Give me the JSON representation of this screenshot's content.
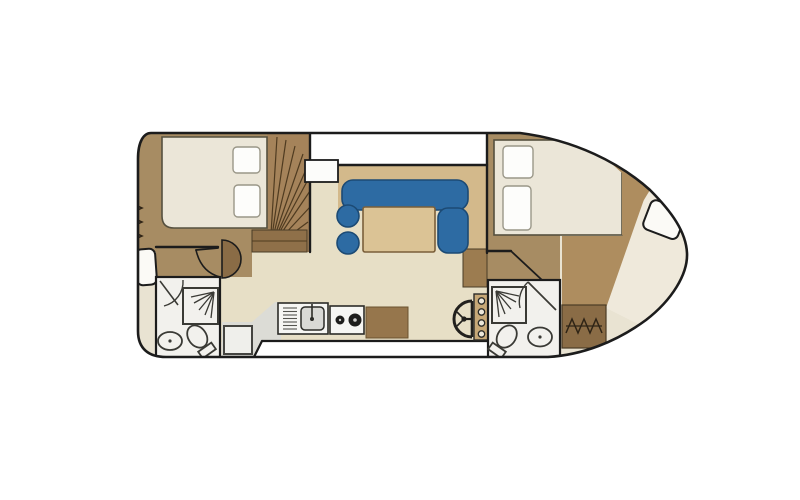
{
  "diagram": {
    "type": "boat-floor-plan",
    "description": "Top-down interior layout plan of a motor cruiser with bow to the right",
    "areas": {
      "stern_deck": {
        "label": "stern deck with boarding steps"
      },
      "aft_cabin": {
        "label": "aft cabin with double bed"
      },
      "staircase": {
        "label": "curved companionway stairs"
      },
      "salon": {
        "label": "salon with L-shaped sofa and table"
      },
      "galley": {
        "label": "galley with sink and stove"
      },
      "helm": {
        "label": "helm station with steering wheel and gauges"
      },
      "aft_bathroom": {
        "label": "aft bathroom with shower, toilet and washbasin"
      },
      "fwd_bathroom": {
        "label": "forward bathroom with shower, toilet and washbasin"
      },
      "fwd_cabin": {
        "label": "forward cabin with double bed"
      },
      "bow_deck": {
        "label": "bow deck with locker seat and steps"
      },
      "walkway": {
        "label": "side walkway deck"
      }
    },
    "fixtures": {
      "bed_aft": {
        "label": "double bed with two pillows"
      },
      "bed_fwd": {
        "label": "double bed with two pillows"
      },
      "sofa": {
        "label": "L-shaped blue sofa"
      },
      "table": {
        "label": "salon table"
      },
      "stools": {
        "label": "two round blue stools"
      },
      "sink_unit": {
        "label": "galley sink with drainer and faucet"
      },
      "stove": {
        "label": "two-burner stove"
      },
      "counter": {
        "label": "galley counter cabinet"
      },
      "fridge": {
        "label": "under-counter unit"
      },
      "wheel": {
        "label": "steering wheel"
      },
      "gauges": {
        "label": "instrument panel with four gauges"
      },
      "shower": {
        "label": "shower tray"
      },
      "toilet": {
        "label": "toilet"
      },
      "basin": {
        "label": "washbasin"
      },
      "bow_seat": {
        "label": "bow locker seat"
      },
      "steps": {
        "label": "deck access steps"
      }
    }
  },
  "colors": {
    "wall": "#1c1c1c",
    "hull_base": "#e9e3d2",
    "cabin_floor": "#a78c63",
    "bow_deck": "#ae8d5f",
    "salon_floor": "#e7dfc6",
    "deck_white": "#ffffff",
    "platform": "#d3b98b",
    "sofa_blue": "#2d6ba3",
    "sofa_border": "#1c4a74",
    "table_fill": "#dbc395",
    "table_border": "#7a5f3a",
    "mattress": "#ebe6d8",
    "mattress_border": "#55503f",
    "pillow": "#fdfdfb",
    "pillow_border": "#9a9788",
    "stairs": "#a5835a",
    "stairs_dark": "#8f7049",
    "stair_line": "#4f3b20",
    "bathroom": "#f2f1ed",
    "fixture_line": "#3a3a35",
    "galley_gray": "#dcdcd6",
    "counter_white": "#f6f6f3",
    "sink_gray": "#d9d9d5",
    "cabinet_brown": "#96764c",
    "steps_brown": "#8a6c46",
    "hatch": "#2f2416",
    "door_leaf": "#8a6c46",
    "console": "#c7a877",
    "gauge_face": "#ece7da",
    "wheel_dark": "#22201d",
    "seat_white": "#fbfaf6",
    "bow_cream": "#efe9db"
  }
}
